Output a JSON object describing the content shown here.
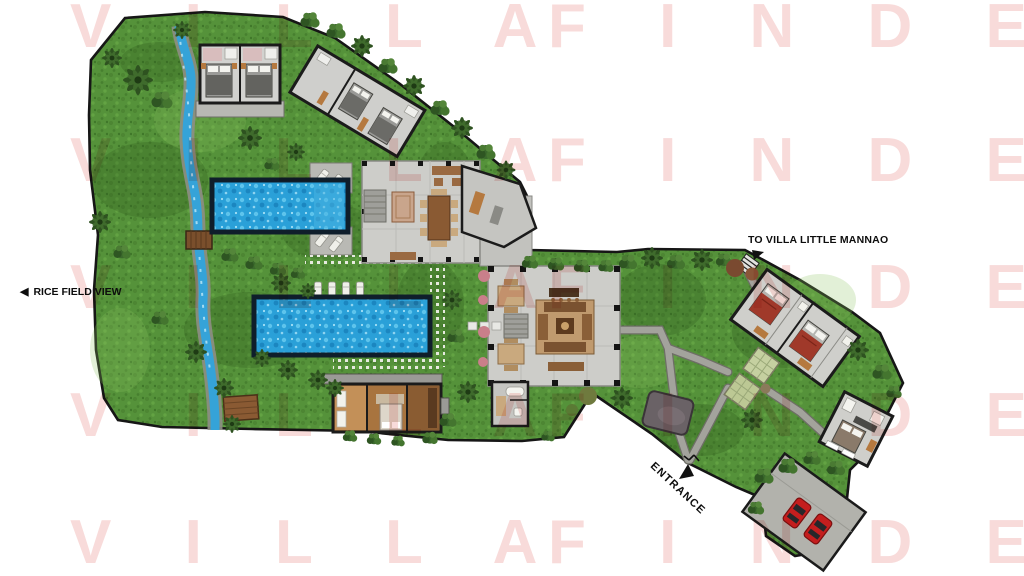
{
  "watermark": {
    "display_left": "V I L L A",
    "display_right": "F I N D E R",
    "color": "#f8dbda",
    "rows": 5
  },
  "labels": {
    "to_villa": "TO VILLA LITTLE MANNAO",
    "rice_field": "RICE FIELD VIEW",
    "rice_field_arrow": "◀",
    "entrance": "ENTRANCE"
  },
  "colors": {
    "background": "#ffffff",
    "grass": "#55923a",
    "pool_water": "#2aa0d8",
    "pool_border": "#0f1e2b",
    "building_floor": "#cfcfcb",
    "wall": "#1b1b1b",
    "path": "#a3a39c",
    "wood_floor": "#a8743f",
    "stream": "#35a3d8",
    "car_red": "#c41e1e"
  },
  "site": {
    "pool_count": 2,
    "parked_car_count": 2,
    "sun_lounger_count": 8,
    "guest_bedroom_buildings": 3
  }
}
